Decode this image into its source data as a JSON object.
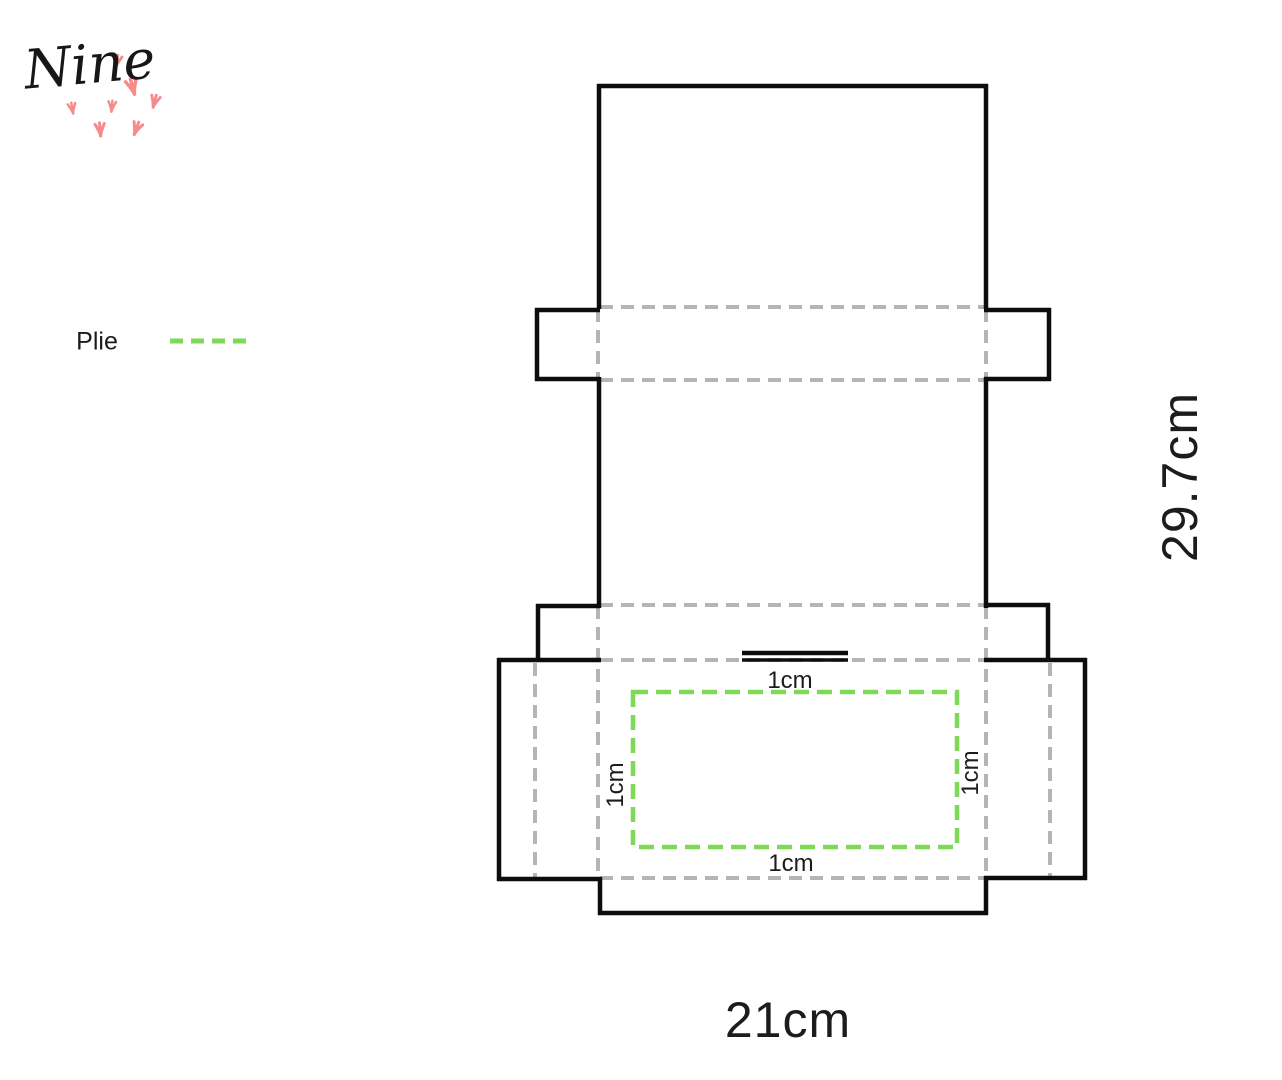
{
  "logo": {
    "text": "Nine"
  },
  "legend": {
    "fold_label": "Plie"
  },
  "dimensions": {
    "sheet_width": "21cm",
    "sheet_height": "29.7cm",
    "inset_top": "1cm",
    "inset_bottom": "1cm",
    "inset_left": "1cm",
    "inset_right": "1cm"
  },
  "colors": {
    "cut_line": "#0d0d0d",
    "fold_line_gray": "#b5b5b5",
    "fold_line_green": "#7ed957",
    "logo_pink": "#f58b8b",
    "text": "#1c1c1c"
  }
}
